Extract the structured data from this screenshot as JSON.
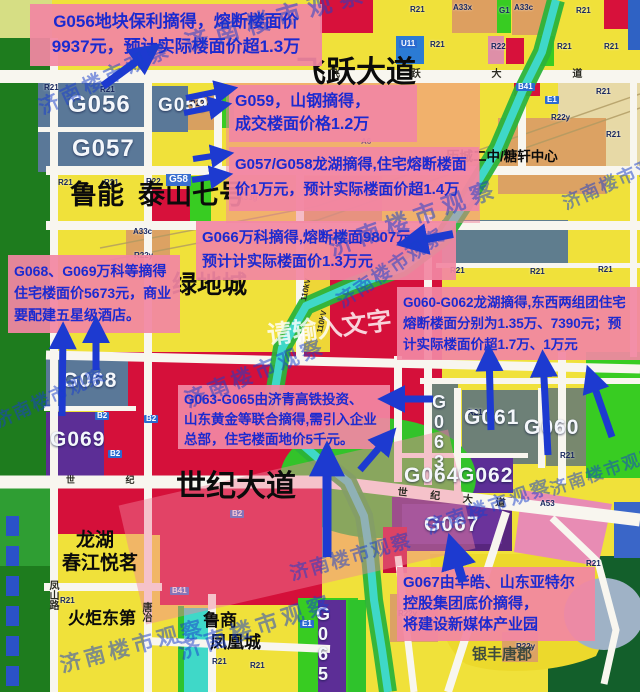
{
  "colors": {
    "arrow": "#1d3ad0",
    "annotation_bg": "#f287a2",
    "annotation_text": "#1b2ad0",
    "watermark_blue": "rgba(25,64,205,0.52)",
    "parcel_red": "#d5103a",
    "parcel_yellow": "#f0e13a",
    "parcel_steel_blue": "#5a7898",
    "parcel_purple": "#5c2e96",
    "park_green": "#33c32a",
    "river_teal": "#3fd8c8"
  },
  "watermark": {
    "brand": "济南楼市观察",
    "input_hint": {
      "text": "请输入文字",
      "x": 266,
      "y": 324,
      "size": 25,
      "rot": -7
    },
    "instances": [
      {
        "x": 182,
        "y": 34,
        "rot": -16,
        "size": 24,
        "ls": 8
      },
      {
        "x": 36,
        "y": 100,
        "rot": -25,
        "size": 20,
        "ls": 4
      },
      {
        "x": 326,
        "y": 238,
        "rot": -20,
        "size": 23,
        "ls": 7
      },
      {
        "x": 182,
        "y": 392,
        "rot": -22,
        "size": 21,
        "ls": 4
      },
      {
        "x": 334,
        "y": 296,
        "rot": -34,
        "size": 19,
        "ls": 2
      },
      {
        "x": 424,
        "y": 520,
        "rot": -19,
        "size": 19,
        "ls": 3
      },
      {
        "x": 288,
        "y": 566,
        "rot": -16,
        "size": 19,
        "ls": 2
      },
      {
        "x": 58,
        "y": 656,
        "rot": -15,
        "size": 21,
        "ls": 4
      },
      {
        "x": 176,
        "y": 642,
        "rot": -18,
        "size": 22,
        "ls": 5
      },
      {
        "x": -8,
        "y": 414,
        "rot": -24,
        "size": 18,
        "ls": 2
      },
      {
        "x": 548,
        "y": 482,
        "rot": -19,
        "size": 17,
        "ls": 2
      },
      {
        "x": 560,
        "y": 196,
        "rot": -24,
        "size": 18,
        "ls": 2
      }
    ]
  },
  "annotations": [
    {
      "id": "g056",
      "lines": [
        "G056地块保利摘得，熔断楼面价",
        "9937元，预计实际楼面价超1.3万"
      ]
    },
    {
      "id": "g059",
      "lines": [
        "G059，山钢摘得，",
        "成交楼面价格1.2万"
      ]
    },
    {
      "id": "g057-g058",
      "lines": [
        "G057/G058龙湖摘得,住宅熔断楼面",
        "价1万元，预计实际楼面价超1.4万"
      ]
    },
    {
      "id": "g066",
      "lines": [
        "G066万科摘得,熔断楼面9807元",
        "预计计实际楼面价1.3万元"
      ]
    },
    {
      "id": "g068-g069",
      "lines": [
        "G068、G069万科等摘得",
        "住宅楼面价5673元，商业",
        "要配建五星级酒店。"
      ]
    },
    {
      "id": "g060-g062",
      "lines": [
        "G060-G062龙湖摘得,东西两组团住宅",
        "熔断楼面分别为1.35万、7390元；预",
        "计实际楼面价超1.7万、1万元"
      ]
    },
    {
      "id": "g063-g065",
      "lines": [
        "G063-G065由济青高铁投资、",
        "山东黄金等联合摘得,需引入企业",
        "总部，住宅楼面地价5千元。"
      ]
    },
    {
      "id": "g067",
      "lines": [
        "G067由华皓、山东亚特尔",
        "控股集团底价摘得，",
        "将建设新媒体产业园"
      ]
    }
  ],
  "places": [
    {
      "id": "feiyue-avenue",
      "text": "飞跃大道"
    },
    {
      "id": "shiji-avenue",
      "text": "世纪大道"
    },
    {
      "id": "luneng",
      "text": "鲁能"
    },
    {
      "id": "taishan-7",
      "text": "泰山七号"
    },
    {
      "id": "greenland-city",
      "text": "绿地城"
    },
    {
      "id": "licheng-school",
      "text": "历城二中/糖轩中心"
    },
    {
      "id": "longhu",
      "text": "龙湖"
    },
    {
      "id": "chunjiang-yueming",
      "text": "春江悦茗"
    },
    {
      "id": "huoju-dongdi",
      "text": "火炬东第"
    },
    {
      "id": "lushang",
      "text": "鲁商"
    },
    {
      "id": "fenghuangcheng",
      "text": "凤凰城"
    },
    {
      "id": "yinfeng-tangjun",
      "text": "银丰唐郡"
    }
  ],
  "parcels": [
    {
      "id": "g056",
      "text": "G056"
    },
    {
      "id": "g057",
      "text": "G057"
    },
    {
      "id": "g059",
      "text": "G059"
    },
    {
      "id": "g058",
      "text": "G58"
    },
    {
      "id": "g068",
      "text": "G068"
    },
    {
      "id": "g069",
      "text": "G069"
    },
    {
      "id": "g063",
      "text": "G063"
    },
    {
      "id": "g061",
      "text": "G061"
    },
    {
      "id": "g060",
      "text": "G060"
    },
    {
      "id": "g064",
      "text": "G064"
    },
    {
      "id": "g062",
      "text": "G062"
    },
    {
      "id": "g067",
      "text": "G067"
    },
    {
      "id": "g065",
      "text": "G065"
    }
  ],
  "zone_codes": [
    {
      "t": "A33x",
      "x": 453,
      "y": 4
    },
    {
      "t": "G1",
      "x": 499,
      "y": 7
    },
    {
      "t": "A33c",
      "x": 514,
      "y": 4
    },
    {
      "t": "R21",
      "x": 410,
      "y": 6
    },
    {
      "t": "R21",
      "x": 576,
      "y": 7
    },
    {
      "t": "U11",
      "x": 399,
      "y": 40,
      "tag": true
    },
    {
      "t": "R21",
      "x": 430,
      "y": 41
    },
    {
      "t": "R22",
      "x": 491,
      "y": 43
    },
    {
      "t": "R21",
      "x": 557,
      "y": 43
    },
    {
      "t": "R21",
      "x": 604,
      "y": 43
    },
    {
      "t": "R21",
      "x": 44,
      "y": 84
    },
    {
      "t": "R21",
      "x": 100,
      "y": 86
    },
    {
      "t": "R22y",
      "x": 190,
      "y": 100
    },
    {
      "t": "B41",
      "x": 516,
      "y": 83,
      "tag": true
    },
    {
      "t": "E1",
      "x": 545,
      "y": 96,
      "tag": true
    },
    {
      "t": "R21",
      "x": 596,
      "y": 88
    },
    {
      "t": "R22y",
      "x": 551,
      "y": 114
    },
    {
      "t": "R21",
      "x": 606,
      "y": 131
    },
    {
      "t": "R21",
      "x": 58,
      "y": 179
    },
    {
      "t": "R21",
      "x": 104,
      "y": 179
    },
    {
      "t": "R22",
      "x": 146,
      "y": 178
    },
    {
      "t": "A33g",
      "x": 238,
      "y": 194
    },
    {
      "t": "A33c",
      "x": 133,
      "y": 228
    },
    {
      "t": "R22y",
      "x": 134,
      "y": 252
    },
    {
      "t": "A6",
      "x": 361,
      "y": 138
    },
    {
      "t": "E1",
      "x": 452,
      "y": 158,
      "tag": true
    },
    {
      "t": "R21",
      "x": 450,
      "y": 267
    },
    {
      "t": "R21",
      "x": 530,
      "y": 268
    },
    {
      "t": "R21",
      "x": 598,
      "y": 266
    },
    {
      "t": "R21",
      "x": 468,
      "y": 409
    },
    {
      "t": "R21",
      "x": 560,
      "y": 452
    },
    {
      "t": "B2",
      "x": 95,
      "y": 412,
      "tag": true
    },
    {
      "t": "B2",
      "x": 144,
      "y": 415,
      "tag": true
    },
    {
      "t": "B2",
      "x": 108,
      "y": 450,
      "tag": true
    },
    {
      "t": "B2",
      "x": 230,
      "y": 510,
      "tag": true
    },
    {
      "t": "R21",
      "x": 60,
      "y": 597
    },
    {
      "t": "B41",
      "x": 170,
      "y": 587,
      "tag": true
    },
    {
      "t": "R21",
      "x": 212,
      "y": 658
    },
    {
      "t": "R22y",
      "x": 398,
      "y": 610
    },
    {
      "t": "R21",
      "x": 250,
      "y": 662
    },
    {
      "t": "A53",
      "x": 540,
      "y": 500
    },
    {
      "t": "E1",
      "x": 300,
      "y": 620,
      "tag": true
    },
    {
      "t": "R22y",
      "x": 516,
      "y": 643
    },
    {
      "t": "R21",
      "x": 586,
      "y": 560
    }
  ],
  "road_labels": [
    {
      "text": "飞 跃 大 道",
      "x": 330,
      "y": 70,
      "size": 10,
      "ls": 34
    },
    {
      "text": "世 纪 大 道",
      "x": 398,
      "y": 488,
      "size": 10,
      "ls": 10,
      "rot": 6
    },
    {
      "text": "世 纪",
      "x": 66,
      "y": 476,
      "size": 9,
      "ls": 24
    },
    {
      "text": "凤山路",
      "x": 47,
      "y": 580,
      "size": 10,
      "vertical": true
    },
    {
      "text": "唐冶",
      "x": 140,
      "y": 602,
      "size": 10,
      "vertical": true
    },
    {
      "text": "110kV",
      "x": 300,
      "y": 300,
      "size": 8,
      "rot": -78
    },
    {
      "text": "110kV",
      "x": 316,
      "y": 332,
      "size": 8,
      "rot": -78
    }
  ],
  "arrows": [
    {
      "x1": 103,
      "y1": 86,
      "x2": 152,
      "y2": 50,
      "w": 8
    },
    {
      "x1": 186,
      "y1": 98,
      "x2": 230,
      "y2": 89,
      "w": 6
    },
    {
      "x1": 184,
      "y1": 113,
      "x2": 224,
      "y2": 105,
      "w": 6
    },
    {
      "x1": 193,
      "y1": 159,
      "x2": 226,
      "y2": 154,
      "w": 6
    },
    {
      "x1": 192,
      "y1": 180,
      "x2": 225,
      "y2": 175,
      "w": 6
    },
    {
      "x1": 453,
      "y1": 234,
      "x2": 407,
      "y2": 243,
      "w": 8
    },
    {
      "x1": 62,
      "y1": 416,
      "x2": 63,
      "y2": 331,
      "w": 7
    },
    {
      "x1": 96,
      "y1": 370,
      "x2": 96,
      "y2": 325,
      "w": 7
    },
    {
      "x1": 491,
      "y1": 430,
      "x2": 489,
      "y2": 353,
      "w": 7
    },
    {
      "x1": 548,
      "y1": 455,
      "x2": 543,
      "y2": 359,
      "w": 7
    },
    {
      "x1": 612,
      "y1": 437,
      "x2": 590,
      "y2": 374,
      "w": 7
    },
    {
      "x1": 433,
      "y1": 399,
      "x2": 387,
      "y2": 399,
      "w": 7
    },
    {
      "x1": 360,
      "y1": 470,
      "x2": 390,
      "y2": 435,
      "w": 7
    },
    {
      "x1": 327,
      "y1": 557,
      "x2": 327,
      "y2": 453,
      "w": 9
    },
    {
      "x1": 463,
      "y1": 582,
      "x2": 452,
      "y2": 545,
      "w": 9
    }
  ]
}
